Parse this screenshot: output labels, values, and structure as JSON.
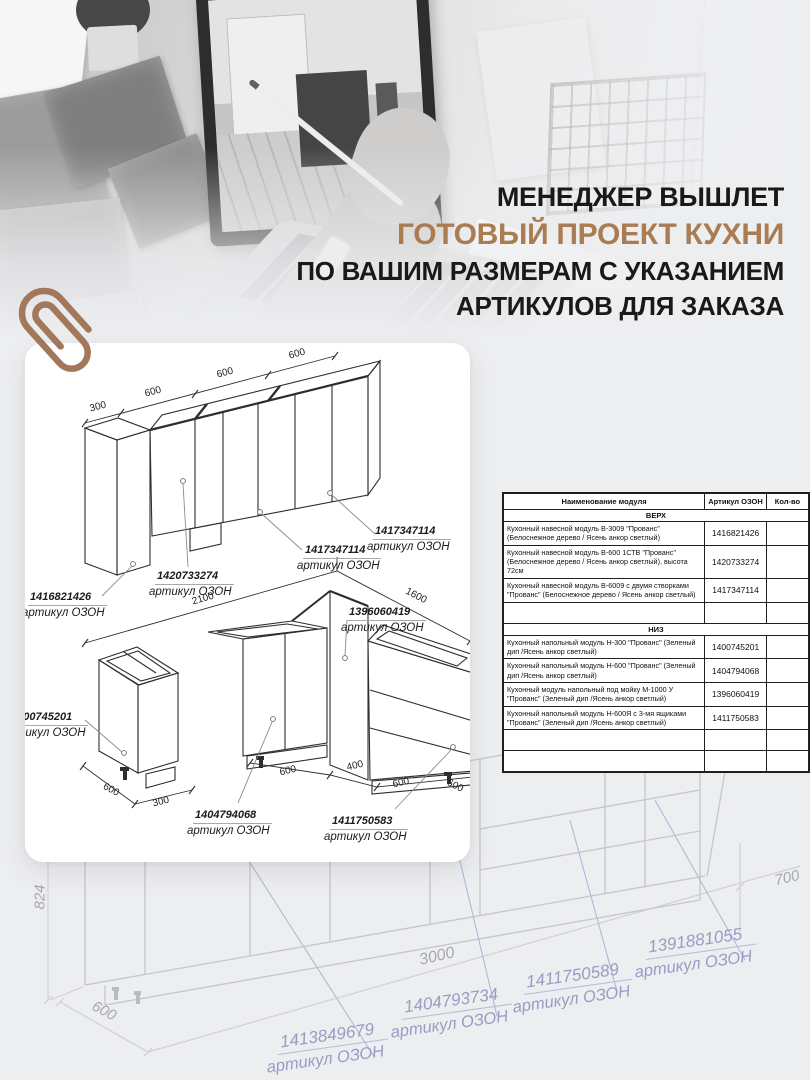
{
  "headline": {
    "line1": "МЕНЕДЖЕР ВЫШЛЕТ",
    "line2": "ГОТОВЫЙ ПРОЕКТ КУХНИ",
    "line3": "ПО ВАШИМ РАЗМЕРАМ С УКАЗАНИЕМ",
    "line4": "АРТИКУЛОВ ДЛЯ ЗАКАЗА",
    "accent_color": "#a97c52"
  },
  "upper_diagram": {
    "dims": [
      "300",
      "600",
      "600",
      "600"
    ],
    "labels": [
      {
        "num": "1416821426",
        "caption": "артикул ОЗОН"
      },
      {
        "num": "1420733274",
        "caption": "артикул ОЗОН"
      },
      {
        "num": "1417347114",
        "caption": "артикул ОЗОН"
      },
      {
        "num": "1417347114",
        "caption": "артикул ОЗОН"
      }
    ]
  },
  "lower_diagram": {
    "dims_top": [
      "2100",
      "1600"
    ],
    "dims_bottom": [
      "600",
      "300",
      "600",
      "400",
      "600",
      "600"
    ],
    "labels": [
      {
        "num": "1400745201",
        "caption": "артикул ОЗОН"
      },
      {
        "num": "1396060419",
        "caption": "артикул ОЗОН"
      },
      {
        "num": "1404794068",
        "caption": "артикул ОЗОН"
      },
      {
        "num": "1411750583",
        "caption": "артикул ОЗОН"
      }
    ]
  },
  "faded_diagram": {
    "dims": [
      "824",
      "600",
      "3000",
      "700"
    ],
    "labels": [
      {
        "num": "1413849679",
        "caption": "артикул ОЗОН"
      },
      {
        "num": "1404793734",
        "caption": "артикул ОЗОН"
      },
      {
        "num": "1411750589",
        "caption": "артикул ОЗОН"
      },
      {
        "num": "1391881055",
        "caption": "артикул ОЗОН"
      }
    ]
  },
  "table": {
    "headers": [
      "Наименование модуля",
      "Артикул ОЗОН",
      "Кол-во"
    ],
    "sections": [
      {
        "title": "ВЕРХ",
        "rows": [
          {
            "name": "Кухонный навесной модуль В-3009 \"Прованс\" (Белоснежное дерево / Ясень анкор светлый)",
            "article": "1416821426"
          },
          {
            "name": "Кухонный навесной модуль В-600 1СТВ \"Прованс\" (Белоснежное дерево / Ясень анкор светлый), высота 72см",
            "article": "1420733274"
          },
          {
            "name": "Кухонный навесной модуль В-6009 с двумя створками \"Прованс\" (Белоснежное дерево / Ясень анкор светлый)",
            "article": "1417347114"
          },
          {
            "name": "",
            "article": ""
          }
        ]
      },
      {
        "title": "НИЗ",
        "rows": [
          {
            "name": "Кухонный напольный модуль Н-300 \"Прованс\" (Зеленый дип /Ясень анкор светлый)",
            "article": "1400745201"
          },
          {
            "name": "Кухонный напольный модуль Н-600 \"Прованс\" (Зеленый дип /Ясень анкор светлый)",
            "article": "1404794068"
          },
          {
            "name": "Кухонный модуль напольный под мойку М-1000 У \"Прованс\" (Зеленый дип /Ясень анкор светлый)",
            "article": "1396060419"
          },
          {
            "name": "Кухонный напольный модуль Н-600Я с 3-мя ящиками \"Прованс\" (Зеленый дип /Ясень анкор светлый)",
            "article": "1411750583"
          },
          {
            "name": "",
            "article": ""
          },
          {
            "name": "",
            "article": ""
          }
        ]
      }
    ]
  }
}
